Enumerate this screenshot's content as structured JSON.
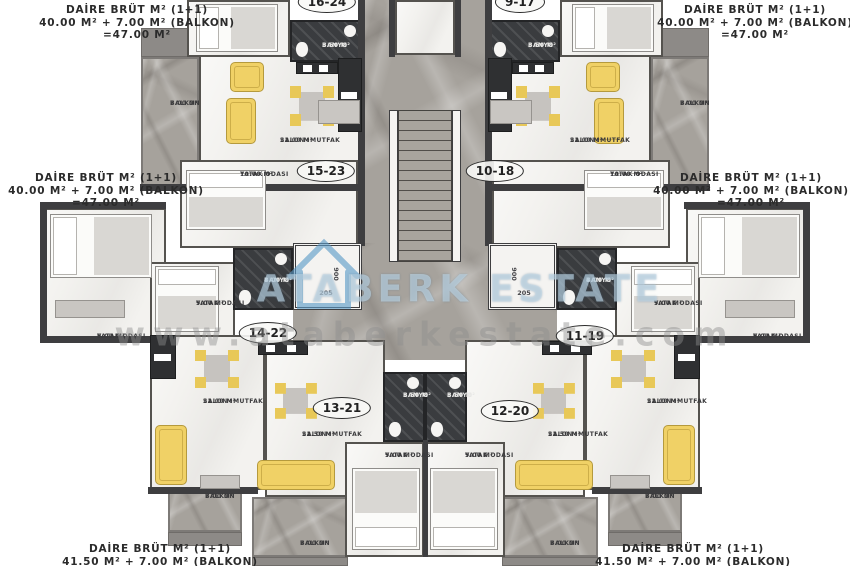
{
  "plan": {
    "type": "residential-floor-plan",
    "language": "Turkish"
  },
  "annotations": {
    "top_left": {
      "lines": [
        "DAİRE BRÜT M² (1+1)",
        "40.00 M² + 7.00 M² (BALKON)",
        "=47.00 M²"
      ]
    },
    "top_right": {
      "lines": [
        "DAİRE BRÜT M² (1+1)",
        "40.00 M² + 7.00 M² (BALKON)",
        "=47.00 M²"
      ]
    },
    "mid_left": {
      "lines": [
        "DAİRE BRÜT M² (1+1)",
        "40.00 M² + 7.00 M² (BALKON)",
        "=47.00 M²"
      ]
    },
    "mid_right": {
      "lines": [
        "DAİRE BRÜT M² (1+1)",
        "40.00 M² + 7.00 M² (BALKON)",
        "=47.00 M²"
      ]
    },
    "bottom_left": {
      "lines": [
        "DAİRE BRÜT M² (1+1)",
        "41.50 M² + 7.00 M² (BALKON)"
      ]
    },
    "bottom_right": {
      "lines": [
        "DAİRE BRÜT M² (1+1)",
        "41.50 M² + 7.00 M² (BALKON)"
      ]
    }
  },
  "watermark": {
    "brand": "ATABERK ESTATE",
    "url": "www.ataberkestate.com",
    "logo": "house-outline-icon",
    "brand_color": "#c1d8e7",
    "url_color": "#8e8e8e"
  },
  "units": [
    {
      "id": "16-24",
      "x": 327,
      "y": 2
    },
    {
      "id": "9-17",
      "x": 520,
      "y": 2
    },
    {
      "id": "15-23",
      "x": 326,
      "y": 171
    },
    {
      "id": "10-18",
      "x": 495,
      "y": 171
    },
    {
      "id": "14-22",
      "x": 268,
      "y": 333
    },
    {
      "id": "11-19",
      "x": 585,
      "y": 336
    },
    {
      "id": "13-21",
      "x": 342,
      "y": 408
    },
    {
      "id": "12-20",
      "x": 510,
      "y": 411
    }
  ],
  "room_labels": [
    {
      "room": "BALKON",
      "area": "7.00 M²",
      "x": 170,
      "y": 100,
      "light": false
    },
    {
      "room": "BALKON",
      "area": "7.00 M²",
      "x": 680,
      "y": 100,
      "light": false
    },
    {
      "room": "BALKON",
      "area": "7.00 M²",
      "x": 205,
      "y": 493,
      "light": false
    },
    {
      "room": "BALKON",
      "area": "7.00 M²",
      "x": 645,
      "y": 493,
      "light": false
    },
    {
      "room": "BALKON",
      "area": "7.00 M²",
      "x": 300,
      "y": 540,
      "light": false
    },
    {
      "room": "BALKON",
      "area": "7.00 M²",
      "x": 550,
      "y": 540,
      "light": false
    },
    {
      "room": "SALON+MUTFAK",
      "area": "22.00 M²",
      "x": 280,
      "y": 137,
      "light": false
    },
    {
      "room": "SALON+MUTFAK",
      "area": "22.00 M²",
      "x": 570,
      "y": 137,
      "light": false
    },
    {
      "room": "SALON+MUTFAK",
      "area": "22.00 M²",
      "x": 203,
      "y": 398,
      "light": false
    },
    {
      "room": "SALON+MUTFAK",
      "area": "22.00 M²",
      "x": 647,
      "y": 398,
      "light": false
    },
    {
      "room": "SALON+MUTFAK",
      "area": "22.50 M²",
      "x": 302,
      "y": 431,
      "light": false
    },
    {
      "room": "SALON+MUTFAK",
      "area": "22.50 M²",
      "x": 548,
      "y": 431,
      "light": false
    },
    {
      "room": "YATAK ODASI",
      "area": "10.00 M²",
      "x": 240,
      "y": 171,
      "light": false
    },
    {
      "room": "YATAK ODASI",
      "area": "10.00 M²",
      "x": 610,
      "y": 171,
      "light": false
    },
    {
      "room": "YATAK ODASI",
      "area": "9.00 M²",
      "x": 97,
      "y": 333,
      "light": false
    },
    {
      "room": "YATAK ODASI",
      "area": "9.00 M²",
      "x": 753,
      "y": 333,
      "light": false
    },
    {
      "room": "YATAK ODASI",
      "area": "9.00 M²",
      "x": 196,
      "y": 300,
      "light": false
    },
    {
      "room": "YATAK ODASI",
      "area": "9.00 M²",
      "x": 654,
      "y": 300,
      "light": false
    },
    {
      "room": "YATAK ODASI",
      "area": "9.00 M²",
      "x": 385,
      "y": 452,
      "light": false
    },
    {
      "room": "YATAK ODASI",
      "area": "9.00 M²",
      "x": 465,
      "y": 452,
      "light": false
    },
    {
      "room": "BANYO",
      "area": "3.50 M²",
      "x": 322,
      "y": 42,
      "light": true
    },
    {
      "room": "BANYO",
      "area": "3.50 M²",
      "x": 528,
      "y": 42,
      "light": true
    },
    {
      "room": "BANYO",
      "area": "4.00 M²",
      "x": 264,
      "y": 277,
      "light": true
    },
    {
      "room": "BANYO",
      "area": "4.00 M²",
      "x": 586,
      "y": 277,
      "light": true
    },
    {
      "room": "BANYO",
      "area": "3.50 M²",
      "x": 403,
      "y": 392,
      "light": true
    },
    {
      "room": "BANYO",
      "area": "3.50 M²",
      "x": 447,
      "y": 392,
      "light": true
    }
  ],
  "elevator_labels": [
    {
      "text": "900",
      "x": 336,
      "y": 274,
      "vertical": true
    },
    {
      "text": "205",
      "x": 326,
      "y": 293,
      "vertical": false
    },
    {
      "text": "900",
      "x": 514,
      "y": 274,
      "vertical": true
    },
    {
      "text": "205",
      "x": 524,
      "y": 293,
      "vertical": false
    }
  ],
  "colors": {
    "marble": "#a6a29c",
    "room_floor": "#f3f2ef",
    "wall": "#3e3e40",
    "bathroom": "#3a3c3f",
    "furniture_yellow": "#f0d166",
    "background": "#ffffff"
  }
}
